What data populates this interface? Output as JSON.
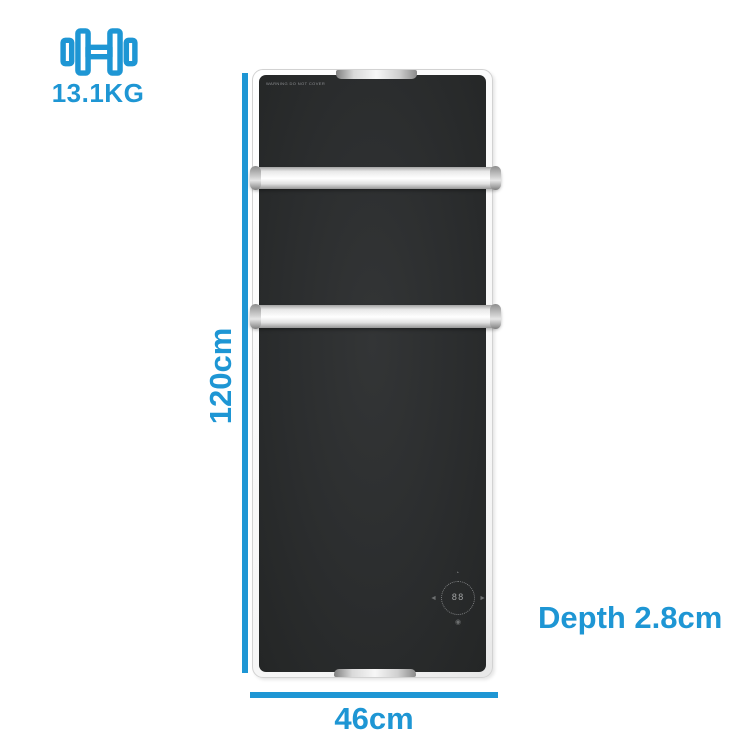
{
  "colors": {
    "accent": "#1e96d4",
    "panel": "#2b2d2e",
    "frame": "#ffffff"
  },
  "annotations": {
    "weight": {
      "value": "13.1KG",
      "icon": "dumbbell-icon"
    },
    "height": {
      "value": "120cm"
    },
    "width": {
      "value": "46cm"
    },
    "depth": {
      "value": "Depth 2.8cm"
    }
  },
  "product": {
    "type": "towel-rail-panel-heater",
    "warning": "WARNING DO NOT COVER",
    "dial": {
      "display": "88",
      "icons": {
        "top": "◔",
        "left": "◄",
        "right": "►",
        "bottom": "◉"
      }
    }
  }
}
